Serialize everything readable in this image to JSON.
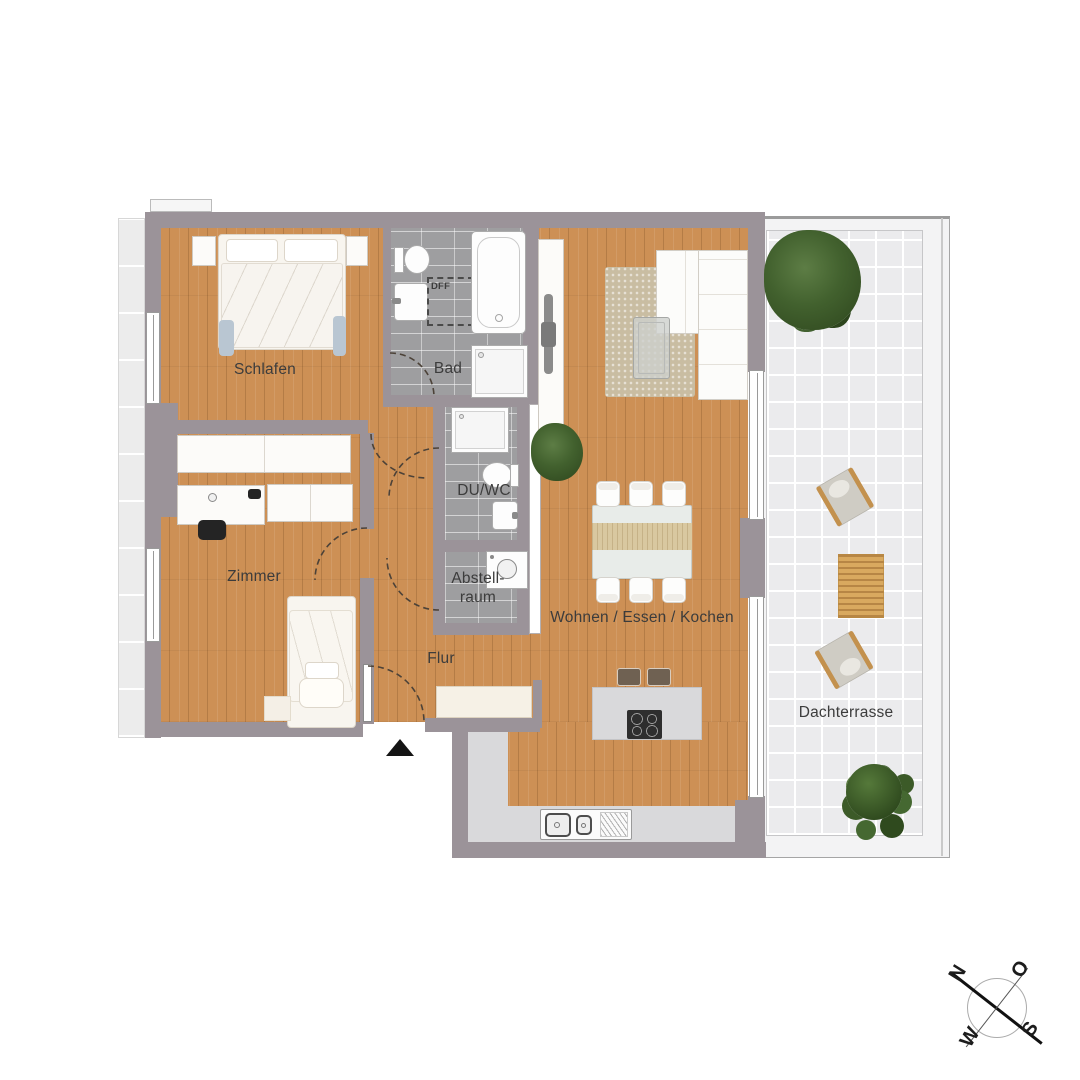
{
  "plan": {
    "title": "Wohnungsgrundriss",
    "rooms": {
      "schlafen": {
        "label": "Schlafen"
      },
      "bad": {
        "label": "Bad"
      },
      "dff": {
        "label": "DFF"
      },
      "du_wc": {
        "label": "DU/WC"
      },
      "abstellraum": {
        "label_line1": "Abstell-",
        "label_line2": "raum"
      },
      "zimmer": {
        "label": "Zimmer"
      },
      "flur": {
        "label": "Flur"
      },
      "wohnen": {
        "label": "Wohnen / Essen / Kochen"
      },
      "dachterrasse": {
        "label": "Dachterrasse"
      }
    },
    "compass": {
      "n": "N",
      "o": "O",
      "s": "S",
      "w": "W"
    },
    "colors": {
      "wall": "#9b9399",
      "wood": "#cd9055",
      "tile_bath": "#9e9ea0",
      "tile_terrace": "#ebebed",
      "counter": "#d9d9db",
      "label": "#3c3c3c",
      "plant_green": "#3f5a2b",
      "bedding_accent": "#b9c6d2",
      "terrace_wood": "#d9a95f"
    }
  }
}
